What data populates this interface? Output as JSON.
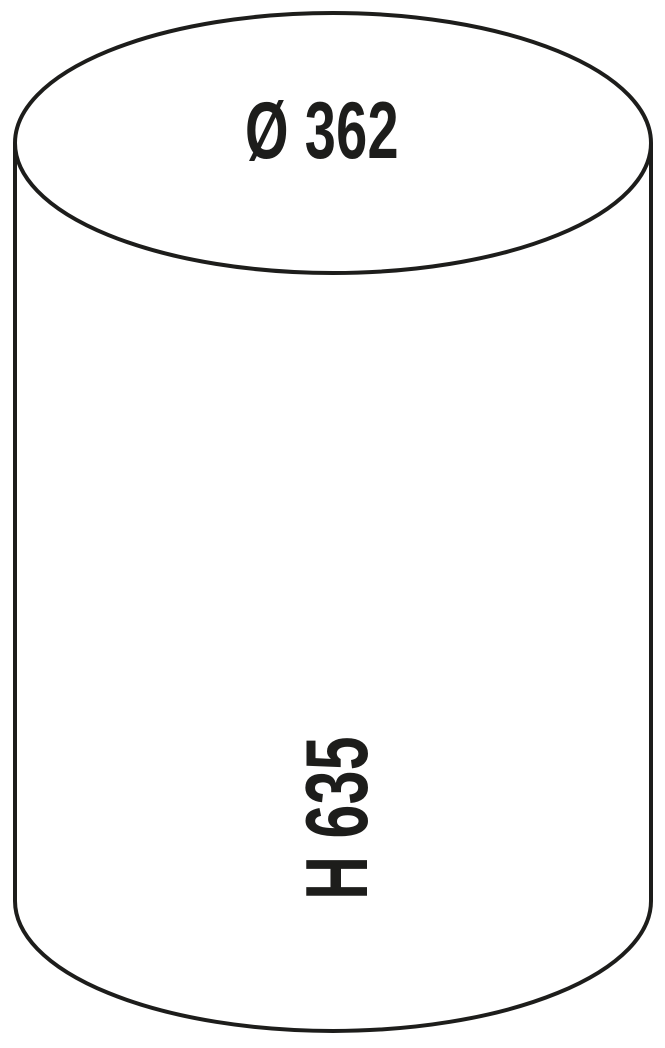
{
  "figure": {
    "type": "cylinder-dimension-diagram",
    "labels": {
      "diameter": "Ø 362",
      "height": "H 635"
    },
    "colors": {
      "line": "#1d1d1b",
      "text": "#1d1d1b",
      "background": "#ffffff"
    }
  }
}
